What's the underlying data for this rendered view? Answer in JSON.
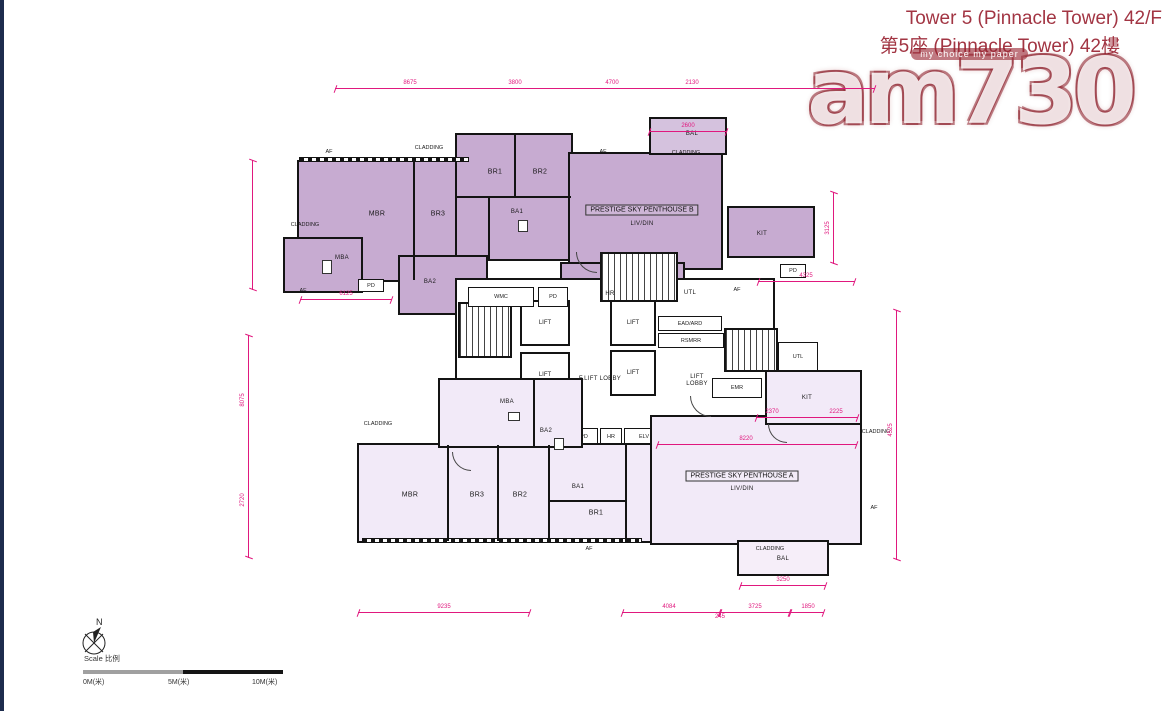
{
  "header": {
    "title_line1": "Tower 5 (Pinnacle Tower) 42/F",
    "title_line2": "第5座 (Pinnacle Tower) 42樓"
  },
  "watermark": {
    "text": "am730",
    "slogan": "my choice my paper"
  },
  "colors": {
    "title": "#a23543",
    "penthouse_b_fill": "#c7abd1",
    "penthouse_a_fill": "#f2eaf8",
    "dimension_line": "#e0187e",
    "wall": "#141414",
    "left_edge": "#1d2c4d",
    "watermark_red": "#8b1a26"
  },
  "plan": {
    "penthouse_b": {
      "label": "PRESTIGE SKY PENTHOUSE B",
      "living": "LIV/DIN",
      "mbr": "MBR",
      "br1": "BR1",
      "br2": "BR2",
      "br3": "BR3",
      "ba1": "BA1",
      "ba2": "BA2",
      "mba": "MBA",
      "bal": "BAL",
      "kit": "KIT",
      "utl": "UTL",
      "pd": "PD"
    },
    "penthouse_a": {
      "label": "PRESTIGE SKY PENTHOUSE A",
      "living": "LIV/DIN",
      "mbr": "MBR",
      "br1": "BR1",
      "br2": "BR2",
      "br3": "BR3",
      "ba1": "BA1",
      "ba2": "BA2",
      "mba": "MBA",
      "bal": "BAL",
      "kit": "KIT",
      "pd": "PD"
    },
    "core": {
      "wmc": "WMC",
      "pd": "PD",
      "lift": "LIFT",
      "f_lift_lobby": "F.LIFT LOBBY",
      "lift_lobby": "LIFT LOBBY",
      "hr": "HR",
      "elv": "ELV",
      "emr": "EMR",
      "ead_ard": "EAD/ARD",
      "rsmrr": "RSMRR",
      "utl": "UTL"
    },
    "annotations": {
      "cladding": "CLADDING",
      "af": "AF"
    },
    "dims": {
      "top1": "8675",
      "top2": "3800",
      "top3": "4700",
      "top4": "2130",
      "bal_b": "2600",
      "mid_6125": "6125",
      "kit_b": "4325",
      "liv_a": "8220",
      "bottom1": "9235",
      "bottom2": "4084",
      "bottom2b": "245",
      "bottom3": "3725",
      "bottom4": "1850",
      "bal_a": "3250",
      "left1": "8075",
      "left2": "2720",
      "right1": "4525",
      "right2": "3125",
      "kit_a1": "2370",
      "kit_a2": "2225"
    }
  },
  "scalebar": {
    "label": "Scale 比例",
    "m0": "0M(米)",
    "m5": "5M(米)",
    "m10": "10M(米)"
  },
  "compass": {
    "label": "N"
  }
}
